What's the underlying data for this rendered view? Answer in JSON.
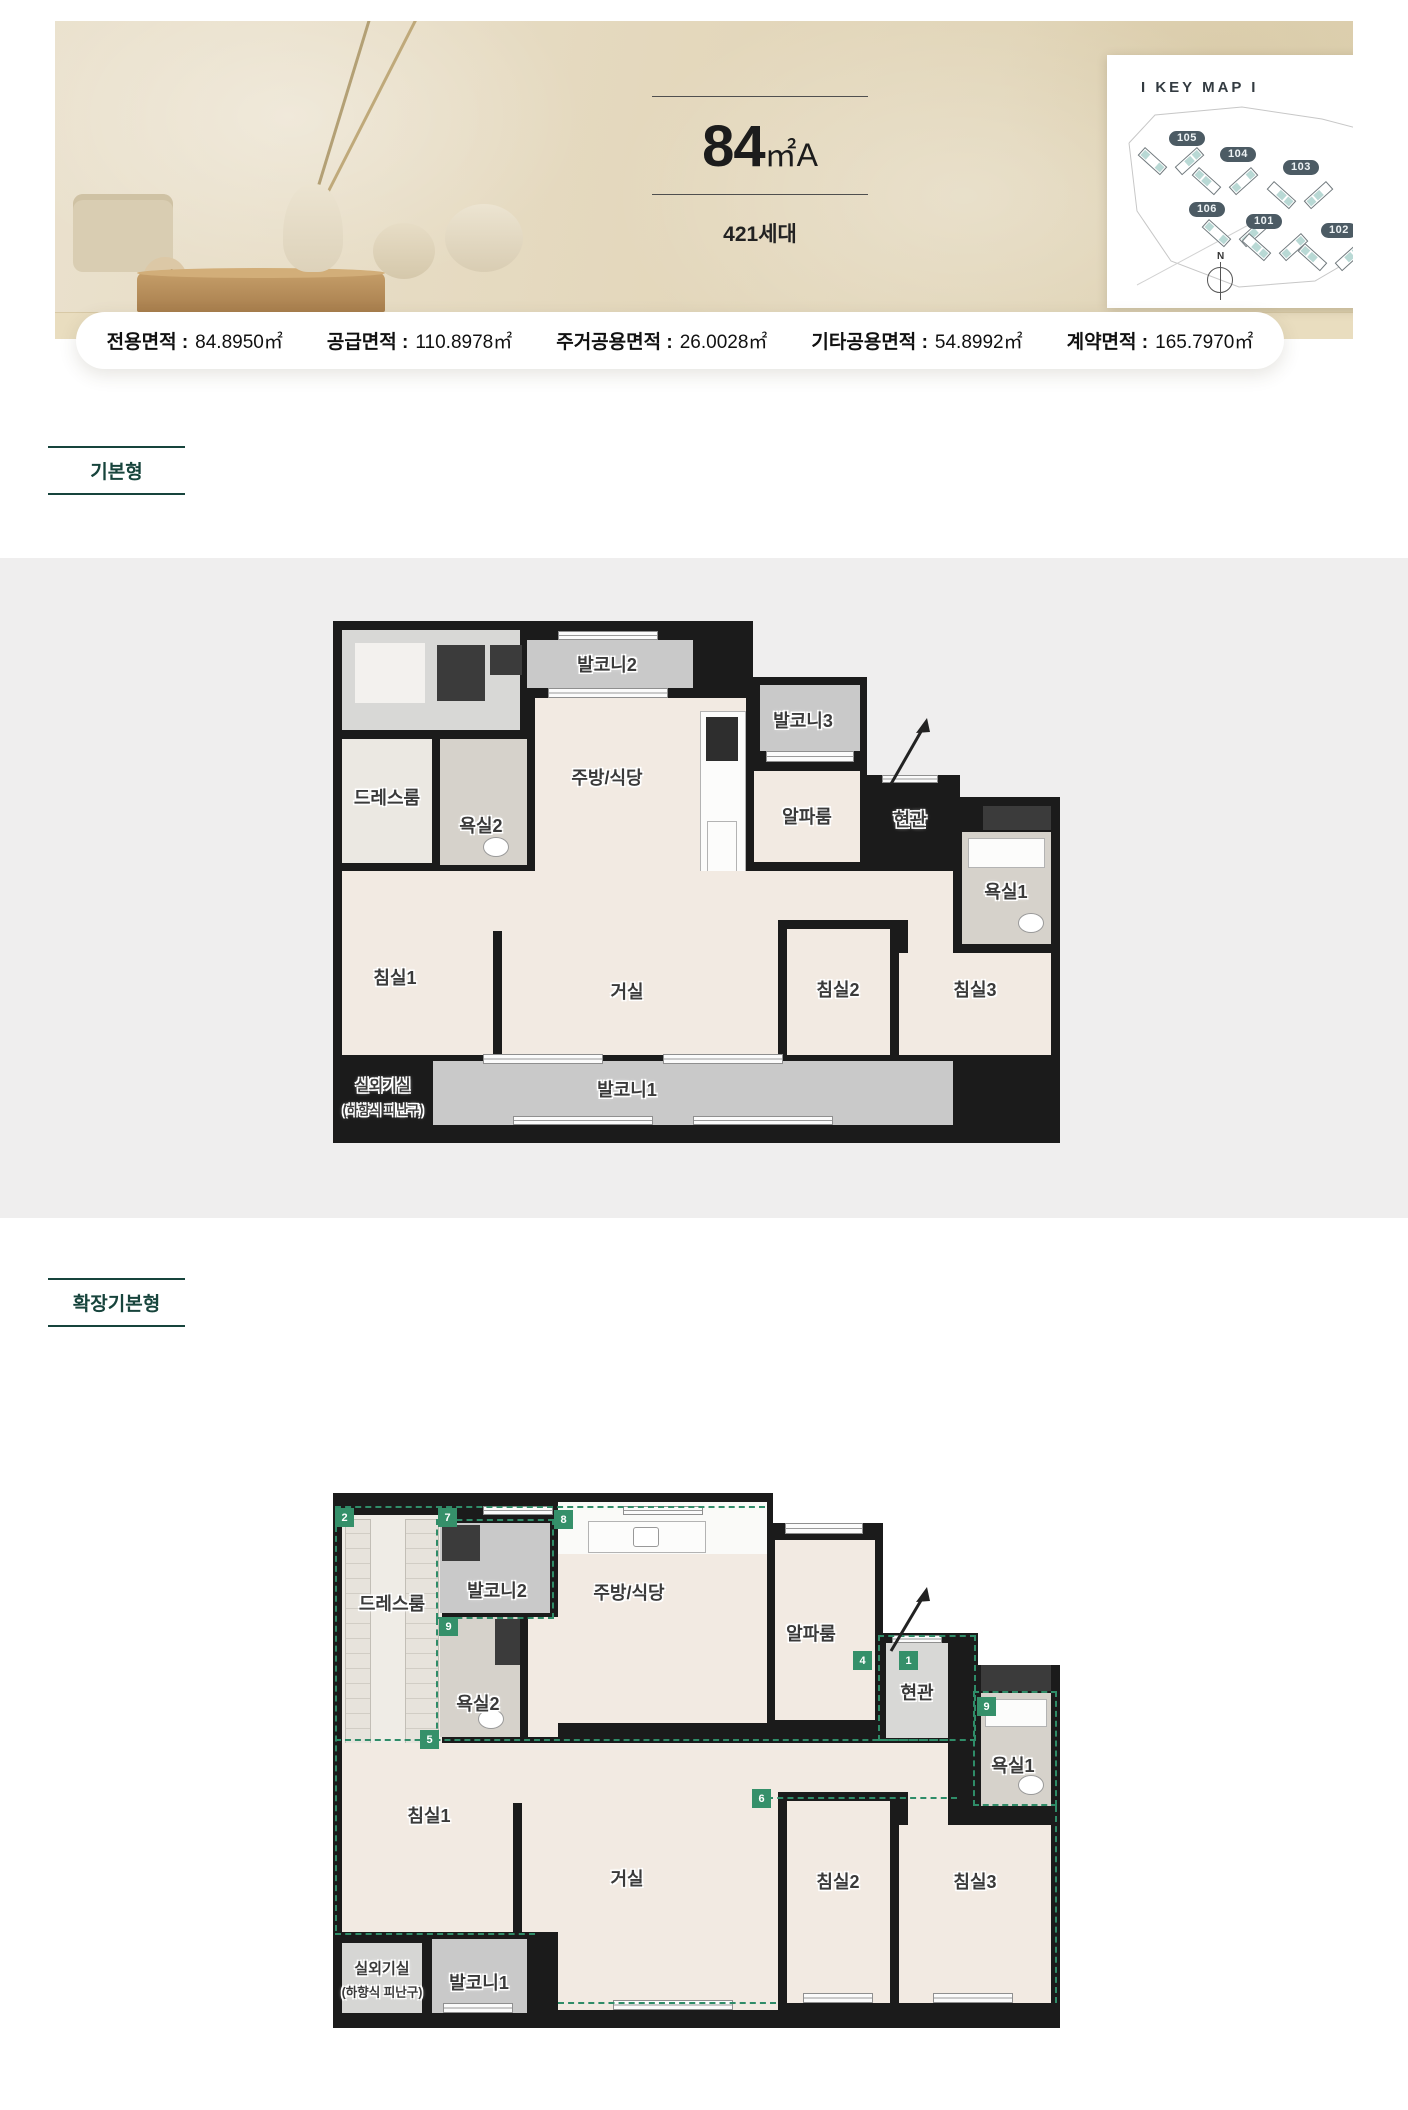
{
  "header": {
    "size_number": "84",
    "size_unit": "㎡A",
    "households": "421세대"
  },
  "keymap": {
    "title": "I KEY MAP I",
    "compass_label": "N",
    "buildings": [
      {
        "id": "105"
      },
      {
        "id": "104"
      },
      {
        "id": "103"
      },
      {
        "id": "106"
      },
      {
        "id": "101"
      },
      {
        "id": "102"
      }
    ]
  },
  "areas": [
    {
      "label": "전용면적 :",
      "value": "84.8950㎡"
    },
    {
      "label": "공급면적 :",
      "value": "110.8978㎡"
    },
    {
      "label": "주거공용면적 :",
      "value": "26.0028㎡"
    },
    {
      "label": "기타공용면적 :",
      "value": "54.8992㎡"
    },
    {
      "label": "계약면적 :",
      "value": "165.7970㎡"
    }
  ],
  "sections": {
    "basic": "기본형",
    "extended": "확장기본형"
  },
  "rooms": {
    "balcony1": "발코니1",
    "balcony2": "발코니2",
    "balcony3": "발코니3",
    "dressroom": "드레스룸",
    "bath1": "욕실1",
    "bath2": "욕실2",
    "kitchen": "주방/식당",
    "alpha": "알파룸",
    "entrance": "현관",
    "bed1": "침실1",
    "bed2": "침실2",
    "bed3": "침실3",
    "living": "거실",
    "outdoor_unit": "실외기실",
    "hatch": "(하향식 피난구)"
  },
  "plan2_badges": [
    "2",
    "7",
    "8",
    "9",
    "5",
    "4",
    "1",
    "9",
    "6"
  ],
  "colors": {
    "accent_green": "#17443c",
    "badge_green": "#35906a",
    "wall": "#1b1b1b"
  }
}
